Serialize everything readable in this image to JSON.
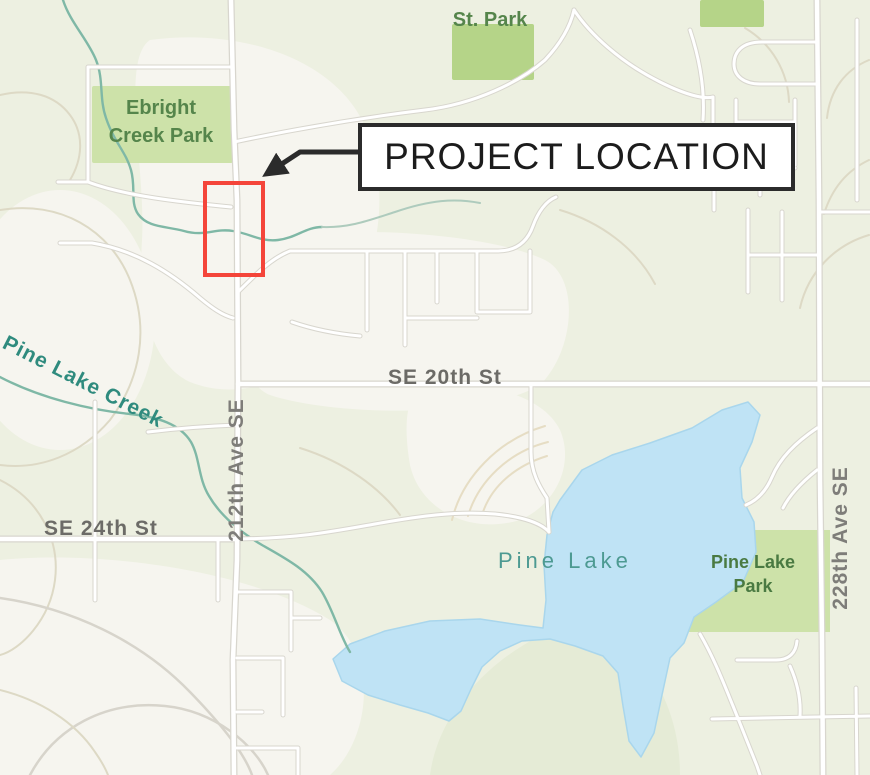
{
  "map": {
    "annotation": {
      "label": "PROJECT LOCATION"
    },
    "labels": {
      "park_top": "St. Park",
      "ebright_line1": "Ebright",
      "ebright_line2": "Creek Park",
      "pine_lake_creek": "Pine Lake Creek",
      "se_20th": "SE 20th St",
      "se_24th": "SE 24th St",
      "ave_212": "212th Ave SE",
      "ave_228": "228th Ave SE",
      "pine_lake": "Pine Lake",
      "pine_lake_park_line1": "Pine Lake",
      "pine_lake_park_line2": "Park"
    },
    "colors": {
      "base": "#edf0e1",
      "terrain_cream": "#f6f5ef",
      "terrain_green": "#e5ebd6",
      "contour": "#ddd9c5",
      "park_green": "#cde2a9",
      "park_bright": "#b5d488",
      "water": "#bfe3f5",
      "water_edge": "#a9d6ec",
      "creek": "#7fb8a6",
      "road_fill": "#ffffff",
      "road_casing": "#d8d6ce",
      "park_label": "#55854b",
      "park_label_dark": "#4a7a42",
      "water_label": "#4d9a92",
      "creek_label": "#2f8b7e",
      "street_label": "#6c6b67",
      "ave_label": "#7e7d79",
      "red_outline": "#f4453a",
      "annotation_text": "#1c1c1c",
      "annotation_border": "#2b2b2b",
      "annotation_bg": "#ffffff",
      "arrow": "#2b2b2b"
    }
  }
}
